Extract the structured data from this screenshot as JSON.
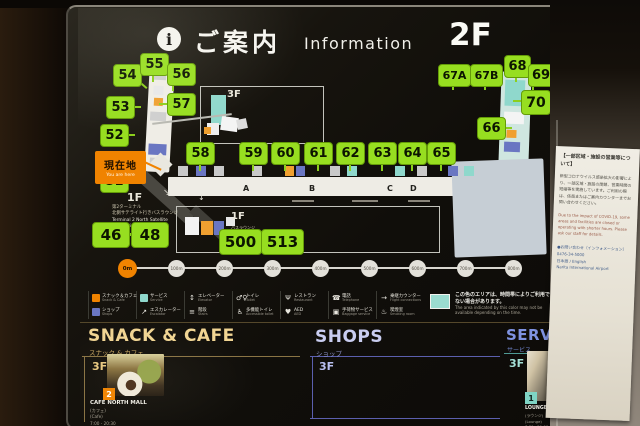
{
  "header": {
    "info_icon": "i",
    "title_jp": "ご案内",
    "title_en": "Information",
    "floor": "2F"
  },
  "map": {
    "current_location": {
      "jp": "現在地",
      "en": "You are here"
    },
    "gates": [
      {
        "label": "54"
      },
      {
        "label": "55"
      },
      {
        "label": "56"
      },
      {
        "label": "53"
      },
      {
        "label": "57"
      },
      {
        "label": "52"
      },
      {
        "label": "51"
      },
      {
        "label": "58"
      },
      {
        "label": "59"
      },
      {
        "label": "60"
      },
      {
        "label": "61"
      },
      {
        "label": "62"
      },
      {
        "label": "63"
      },
      {
        "label": "64"
      },
      {
        "label": "65"
      },
      {
        "label": "66"
      },
      {
        "label": "67A"
      },
      {
        "label": "67B"
      },
      {
        "label": "68"
      },
      {
        "label": "69"
      },
      {
        "label": "70"
      },
      {
        "label": "46"
      },
      {
        "label": "48"
      },
      {
        "label": "500"
      },
      {
        "label": "513"
      }
    ],
    "gate_letters": [
      "A",
      "B",
      "C",
      "D"
    ],
    "inset_3f_label": "3F",
    "left_1f_label": "1F",
    "left_1f_caption": [
      "第2ターミナル",
      "北側サテライト行きバスラウンジ",
      "Terminal 2 North Satellite",
      "Connecting Bus Lounge"
    ],
    "right_1f_label": "1F",
    "right_1f_caption": [
      "バスラウンジ",
      "Bus Lounge"
    ],
    "scale": {
      "start": "0m",
      "marks": [
        "100m",
        "200m",
        "300m",
        "400m",
        "500m",
        "600m",
        "700m",
        "800m"
      ]
    },
    "note": {
      "jp": "この色のエリアは、時間帯によりご利用できない場合があります。",
      "en": "The area indicated by this color may not be available depending on the time."
    }
  },
  "legend": {
    "items": [
      {
        "color": "#f08300",
        "jp": "スナック＆カフェ",
        "en": "Snack & Cafe"
      },
      {
        "color": "#6a76c2",
        "jp": "ショップ",
        "en": "Shops"
      },
      {
        "color": "#8fd8cc",
        "jp": "サービス",
        "en": "Service"
      },
      {
        "icon": "↗",
        "jp": "エスカレーター",
        "en": "Escalator"
      },
      {
        "icon": "↕",
        "jp": "エレベーター",
        "en": "Elevator"
      },
      {
        "icon": "≡",
        "jp": "階段",
        "en": "Stairs"
      },
      {
        "icon": "♂♀",
        "jp": "トイレ",
        "en": "Toilet"
      },
      {
        "icon": "♿",
        "jp": "多機能トイレ",
        "en": "Accessible toilet"
      },
      {
        "icon": "Ψ",
        "jp": "レストラン",
        "en": "Restaurant"
      },
      {
        "icon": "♥",
        "jp": "AED",
        "en": "AED"
      },
      {
        "icon": "☎",
        "jp": "電話",
        "en": "Telephone"
      },
      {
        "icon": "▣",
        "jp": "手荷物サービス",
        "en": "Baggage service"
      },
      {
        "icon": "→",
        "jp": "乗継カウンター",
        "en": "Flight connections"
      },
      {
        "icon": "♨",
        "jp": "喫煙室",
        "en": "Smoking room"
      }
    ]
  },
  "sections": {
    "snack": {
      "title": "SNACK & CAFE",
      "subtitle": "スナック & カフェ",
      "floor": "3F",
      "item": {
        "badge": "2",
        "name": "CAFE NORTH MALL",
        "lines": [
          "(カフェ)",
          "(Cafe)",
          "7:00 - 20:30"
        ]
      }
    },
    "shops": {
      "title": "SHOPS",
      "subtitle": "ショップ",
      "floor": "3F"
    },
    "service": {
      "title": "SERVICE",
      "subtitle": "サービス",
      "floor": "3F",
      "item": {
        "badge": "1",
        "name": "LOUNGE NORTH",
        "lines": [
          "(ラウンジ)",
          "(Lounge)",
          "7:30 - 21:00"
        ]
      }
    }
  },
  "placard": {
    "title": "【一部区域・施設の営業等について】",
    "body_jp": "新型コロナウイルス感染拡大の影響により、一部区域・施設の閉鎖、営業時間の短縮等を実施しています。ご利用の際は、係員またはご案内カウンターまでお問い合わせください。",
    "body_en": "Due to the impact of COVID-19, some areas and facilities are closed or operating with shorter hours. Please ask our staff for details.",
    "contact": [
      "●お問い合わせ（インフォメーション）",
      "0476-34-5000",
      "日本語 / English",
      "Narita International Airport"
    ]
  }
}
